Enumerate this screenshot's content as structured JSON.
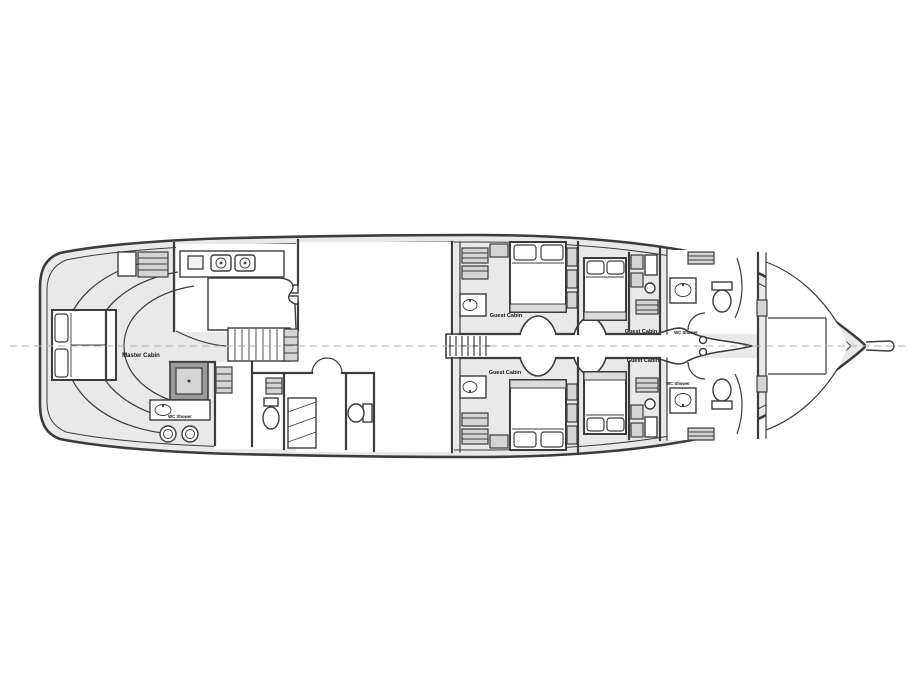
{
  "colors": {
    "background": "#ffffff",
    "line": "#3c3c3c",
    "deck_fill": "#e9e9e9",
    "room_fill": "#ffffff",
    "shower_fill": "#9a9a9a",
    "furniture_fill": "#f2f2f2",
    "foot_band": "#dcdcdc",
    "hatch_fill": "#d4d4d4",
    "label": "#141414",
    "centerline": "#b0b0b0"
  },
  "labels": {
    "master_cabin": "Master Cabin",
    "guest_cabin_aft_top": "Guest Cabin",
    "guest_cabin_aft_bottom": "Guest Cabin",
    "guest_cabin_fwd_top": "Guest Cabin",
    "guest_cabin_fwd_bottom": "Guest Cabin",
    "wc_shower_aft": "WC Shower",
    "wc_shower_fwd_top": "WC Shower",
    "wc_shower_fwd_bottom": "WC Shower"
  }
}
